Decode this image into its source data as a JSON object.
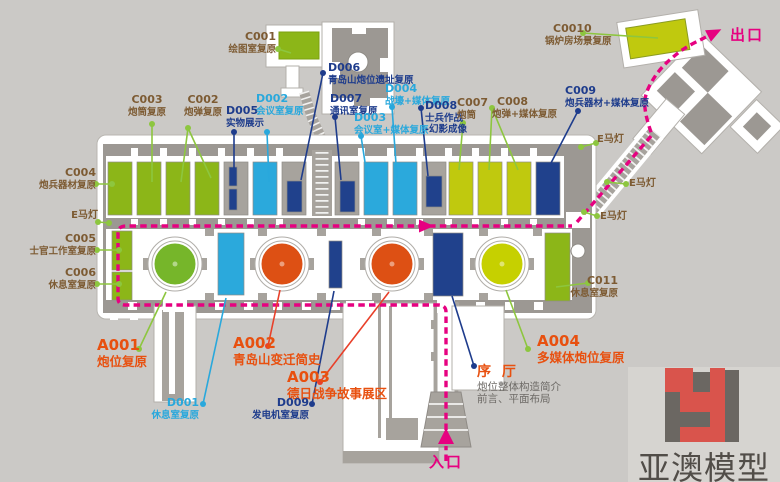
{
  "title": "炮台展览布局平面图",
  "labels": {
    "c001": {
      "code": "C001",
      "name": "绘图室复原"
    },
    "c002": {
      "code": "C002",
      "name": "炮弹复原"
    },
    "c003": {
      "code": "C003",
      "name": "炮筒复原"
    },
    "c004": {
      "code": "C004",
      "name": "炮兵器材复原"
    },
    "c005": {
      "code": "C005",
      "name": "士官工作室复原"
    },
    "c006": {
      "code": "C006",
      "name": "休息室复原"
    },
    "c007": {
      "code": "C007",
      "name": "炮筒"
    },
    "c008": {
      "code": "C008",
      "name": "炮弹+媒体复原"
    },
    "c009": {
      "code": "C009",
      "name": "炮兵器材+媒体复原"
    },
    "c0010": {
      "code": "C0010",
      "name": "锅炉房场景复原"
    },
    "c011": {
      "code": "C011",
      "name": "休息室复原"
    },
    "d001": {
      "code": "D001",
      "name": "休息室复原"
    },
    "d002": {
      "code": "D002",
      "name": "会议室复原"
    },
    "d003": {
      "code": "D003",
      "name": "会议室+媒体复原"
    },
    "d004": {
      "code": "D004",
      "name": "战壕+媒体复原"
    },
    "d005": {
      "code": "D005",
      "name": "实物展示"
    },
    "d006": {
      "code": "D006",
      "name": "青岛山炮位遗址复原"
    },
    "d007": {
      "code": "D007",
      "name": "通讯室复原"
    },
    "d008": {
      "code": "D008",
      "name": "士兵作战",
      "name2": "-幻影成像"
    },
    "d009": {
      "code": "D009",
      "name": "发电机室复原"
    },
    "a001": {
      "code": "A001",
      "name": "炮位复原"
    },
    "a002": {
      "code": "A002",
      "name": "青岛山变迁简史"
    },
    "a003": {
      "code": "A003",
      "name": "德日战争故事展区"
    },
    "a004": {
      "code": "A004",
      "name": "多媒体炮位复原"
    },
    "xuting": {
      "code": "序 厅",
      "line1": "炮位整体构造简介",
      "line2": "前言、平面布局"
    },
    "lamp": "E马灯",
    "entrance": "入口",
    "exit": "出口"
  },
  "logo": {
    "text": "亚澳模型"
  },
  "colors": {
    "background": "#cbc9c6",
    "wall": "#9c9893",
    "floor": "#a7a39d",
    "roomGreen": "#8cb618",
    "circleGreen": "#76b62a",
    "cyan": "#2ba9dc",
    "navy": "#20418c",
    "orangeCircle": "#dd5014",
    "yellowCircle": "#c6d000",
    "yellowGreenRoom": "#c0c90e",
    "routePink": "#e60180",
    "labelBrown": "#7d5b33",
    "labelNavy": "#1e3c8c",
    "labelCyan": "#29a8dc",
    "labelOrange": "#e8500f",
    "labelGray": "#6d6a66",
    "pointerGreen": "#8dc63f",
    "pointerRed": "#e8402a",
    "logoRed": "#d9544c",
    "logoGray": "#6b6762"
  }
}
